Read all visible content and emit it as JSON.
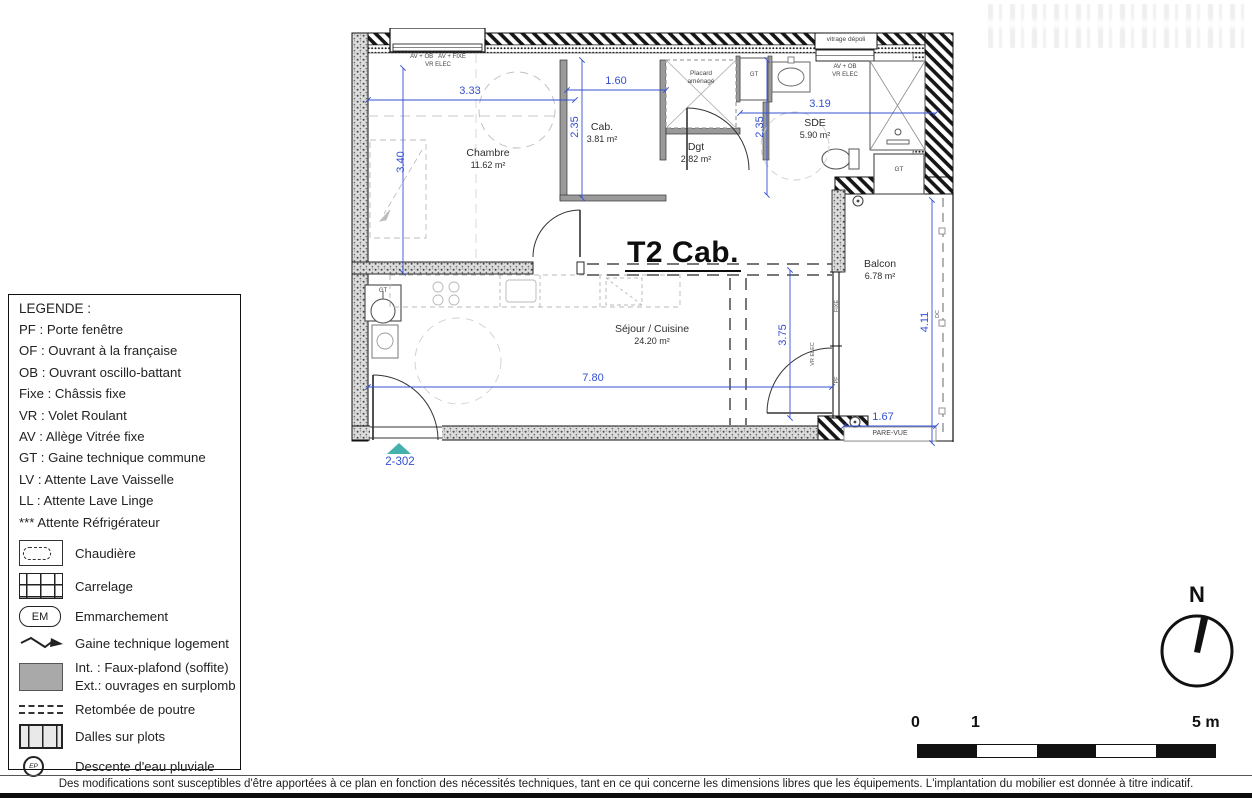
{
  "colors": {
    "dimension": "#3450d2",
    "entry_marker": "#45b1ad"
  },
  "legend": {
    "title": "LEGENDE :",
    "abbreviations": [
      "PF : Porte fenêtre",
      "OF : Ouvrant à la française",
      "OB : Ouvrant oscillo-battant",
      "Fixe : Châssis fixe",
      "VR : Volet Roulant",
      "AV : Allège Vitrée fixe",
      "GT : Gaine technique commune",
      "LV : Attente Lave Vaisselle",
      "LL : Attente Lave Linge",
      "*** Attente Réfrigérateur"
    ],
    "symbols": {
      "chaudiere": "Chaudière",
      "carrelage": "Carrelage",
      "emmarchement": "Emmarchement",
      "em_badge": "EM",
      "gaine": "Gaine technique logement",
      "faux_plafond_int": "Int. : Faux-plafond (soffite)",
      "faux_plafond_ext": "Ext.: ouvrages en surplomb",
      "retombee": "Retombée de poutre",
      "dalles": "Dalles sur plots",
      "descente": "Descente d'eau pluviale",
      "ep_badge": "EP"
    }
  },
  "plan": {
    "title": "T2 Cab.",
    "unit_label": "2-302",
    "rooms": {
      "chambre": {
        "name": "Chambre",
        "area": "11.62 m²"
      },
      "cab": {
        "name": "Cab.",
        "area": "3.81 m²"
      },
      "dgt": {
        "name": "Dgt",
        "area": "2.82 m²"
      },
      "sde": {
        "name": "SDE",
        "area": "5.90 m²"
      },
      "sejour": {
        "name": "Séjour / Cuisine",
        "area": "24.20 m²"
      },
      "balcon": {
        "name": "Balcon",
        "area": "6.78 m²"
      }
    },
    "dims": {
      "chambre_w": "3.33",
      "chambre_h": "3.40",
      "cab_w": "1.60",
      "cab_h": "2.35",
      "sde_w": "3.19",
      "sde_h": "2.35",
      "sejour_w": "7.80",
      "sejour_h": "3.75",
      "balcon_h": "4.11",
      "balcon_w": "1.67"
    },
    "annotations": {
      "window_chambre_1": "AV + OB",
      "window_chambre_2": "AV + FIXE",
      "vr_elec": "VR ELEC",
      "vitrage": "vitrage dépoli",
      "window_sde": "AV + OB",
      "placard_l1": "Placard",
      "placard_l2": "aménagé",
      "gt": "GT",
      "fixe": "FIXE",
      "pf": "PF",
      "dc": "DC",
      "pare_vue": "PARE-VUE"
    }
  },
  "north_label": "N",
  "scale": {
    "t0": "0",
    "t1": "1",
    "t5": "5 m"
  },
  "footer": {
    "disclaimer": "Des modifications sont susceptibles d'être apportées à ce plan en fonction des nécessités techniques, tant en ce qui concerne les dimensions libres que les équipements. L'implantation du mobilier est donnée à titre indicatif."
  }
}
